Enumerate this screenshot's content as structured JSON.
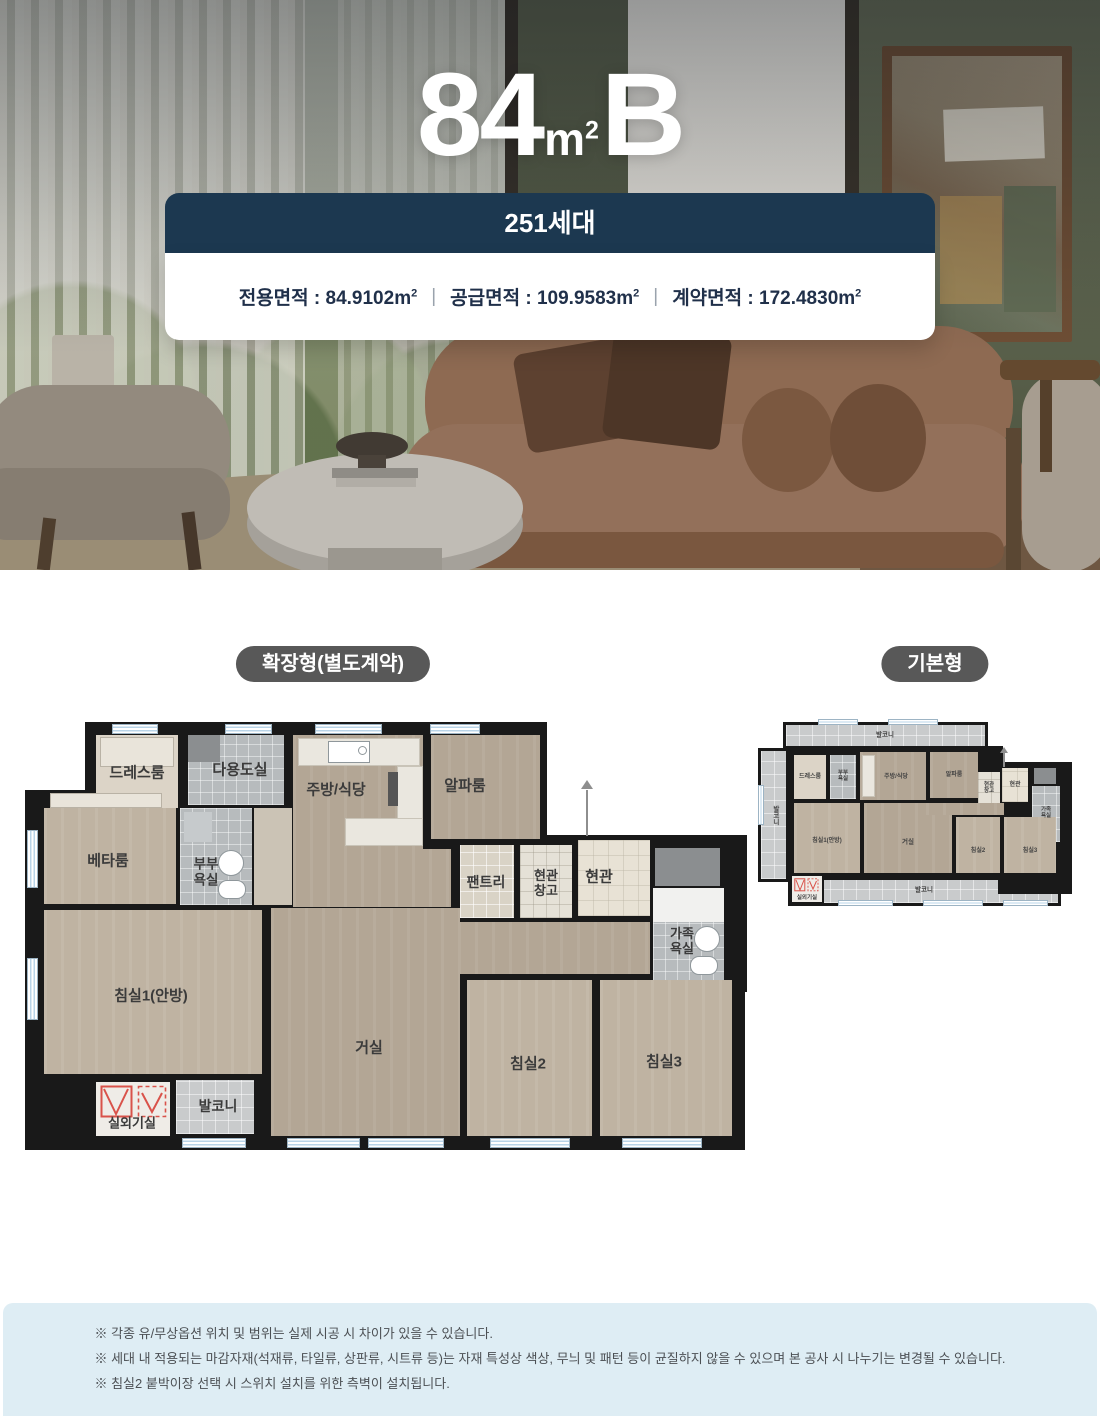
{
  "hero": {
    "title_num": "84",
    "title_unit_base": "m",
    "title_unit_sup": "2",
    "title_letter": "B"
  },
  "banner": {
    "households": "251세대"
  },
  "area_card": {
    "colon": " : ",
    "separator": "|",
    "unit_base": "m",
    "unit_sup": "2",
    "items": [
      {
        "label": "전용면적",
        "value": "84.9102"
      },
      {
        "label": "공급면적",
        "value": "109.9583"
      },
      {
        "label": "계약면적",
        "value": "172.4830"
      }
    ]
  },
  "badges": {
    "extended": "확장형(별도계약)",
    "basic": "기본형"
  },
  "room_labels": {
    "dress": "드레스룸",
    "utility": "다용도실",
    "kitchen": "주방/식당",
    "alpha": "알파룸",
    "beta": "베타룸",
    "master_bath": "부부\n욕실",
    "pantry": "팬트리",
    "entry_storage": "현관\n창고",
    "entry": "현관",
    "family_bath": "가족\n욕실",
    "bed1": "침실1(안방)",
    "living": "거실",
    "bed2": "침실2",
    "bed3": "침실3",
    "outdoor": "실외기실",
    "balcony": "발코니"
  },
  "notes": [
    "※ 각종 유/무상옵션 위치 및 범위는 실제 시공 시 차이가 있을 수 있습니다.",
    "※ 세대 내 적용되는 마감자재(석재류, 타일류, 상판류, 시트류 등)는 자재 특성상 색상, 무늬 및 패턴 등이 균질하지 않을 수 있으며 본 공사 시 나누기는 변경될 수 있습니다.",
    "※ 침실2 붙박이장 선택 시 스위치 설치를 위한 측벽이 설치됩니다."
  ],
  "colors": {
    "accent_navy": "#1c3850",
    "badge_gray": "#585858",
    "footer_bg": "#deedf4",
    "plan_wall": "#191919",
    "warning_red": "#d9524a"
  }
}
